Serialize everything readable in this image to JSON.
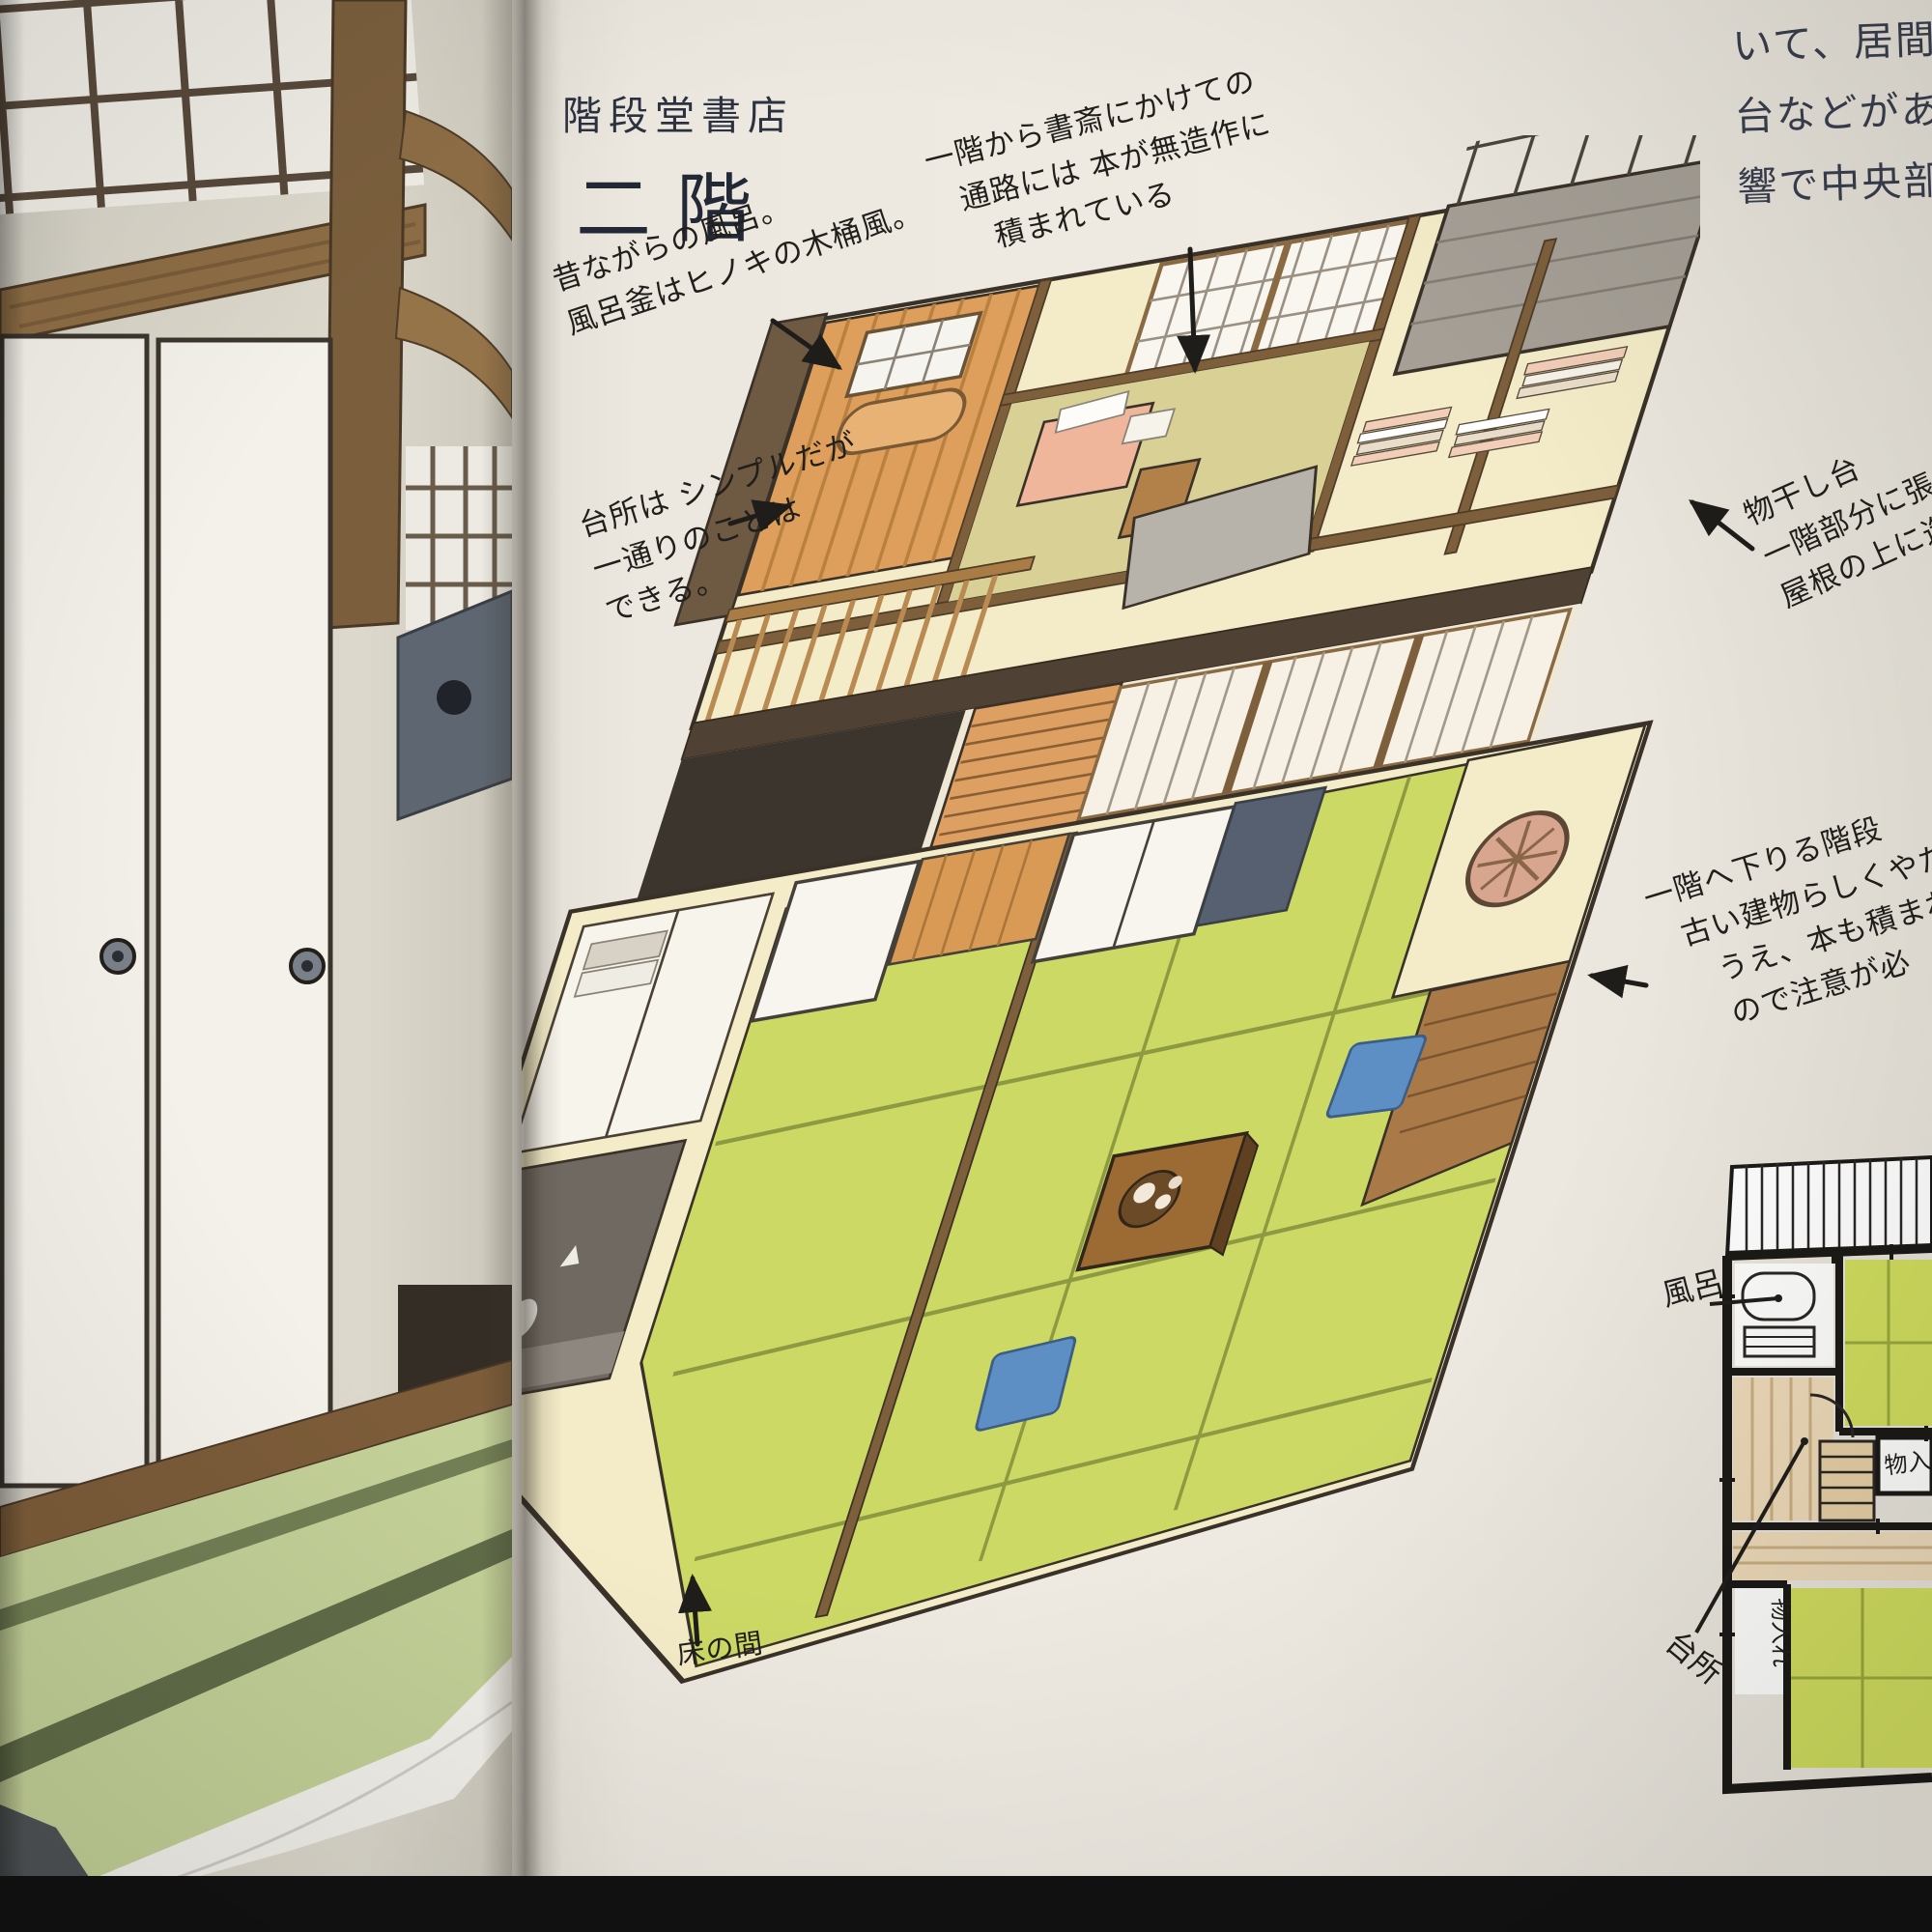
{
  "title": {
    "shop_name": "階段堂書店",
    "heading": "二階"
  },
  "column_text": {
    "lines": [
      "いて、居間、",
      "台などがある",
      "響で中央部分"
    ]
  },
  "annotations": [
    {
      "id": "corridor-books",
      "lines": [
        "一階から書斎にかけての",
        "通路には 本が無造作に",
        "積まれている"
      ]
    },
    {
      "id": "bath",
      "lines": [
        "昔ながらの風呂。",
        "風呂釜はヒノキの木桶風。"
      ]
    },
    {
      "id": "kitchen",
      "lines": [
        "台所は シンプルだが",
        "一通りのことは",
        "できる。"
      ]
    },
    {
      "id": "drying-deck",
      "lines": [
        "物干し台",
        "一階部分に張り出し",
        "屋根の上に造ら"
      ]
    },
    {
      "id": "stairs-down",
      "lines": [
        "一階へ下りる階段",
        "古い建物らしくやた",
        "うえ、本も積まれ",
        "ので注意が必"
      ]
    },
    {
      "id": "tokonoma",
      "lines": [
        "床の間"
      ]
    }
  ],
  "floor_plan": {
    "labels": {
      "bath": "風呂",
      "kitchen": "台所",
      "closet_right": "物入",
      "closet_lower": "物入れ"
    }
  },
  "colors": {
    "photo_black": "#131313",
    "paper_right": "#ece8e0",
    "paper_left": "#d8d4c9",
    "ink": "#211f1b",
    "printed_text": "#2c3140",
    "wall_cream": "#f4ecc8",
    "wood_mid": "#8a6a44",
    "wood_dark": "#4f4234",
    "wood_orange": "#de9f5c",
    "tatami_drawing": "#ccd965",
    "tatami_left_page": "#c3d097",
    "deck_grey": "#a59f96",
    "desk_pink": "#f0b69c",
    "cushion_blue": "#5d8fc5",
    "plan_green": "#d0dd5e",
    "plan_tan": "#ecd9b8"
  }
}
